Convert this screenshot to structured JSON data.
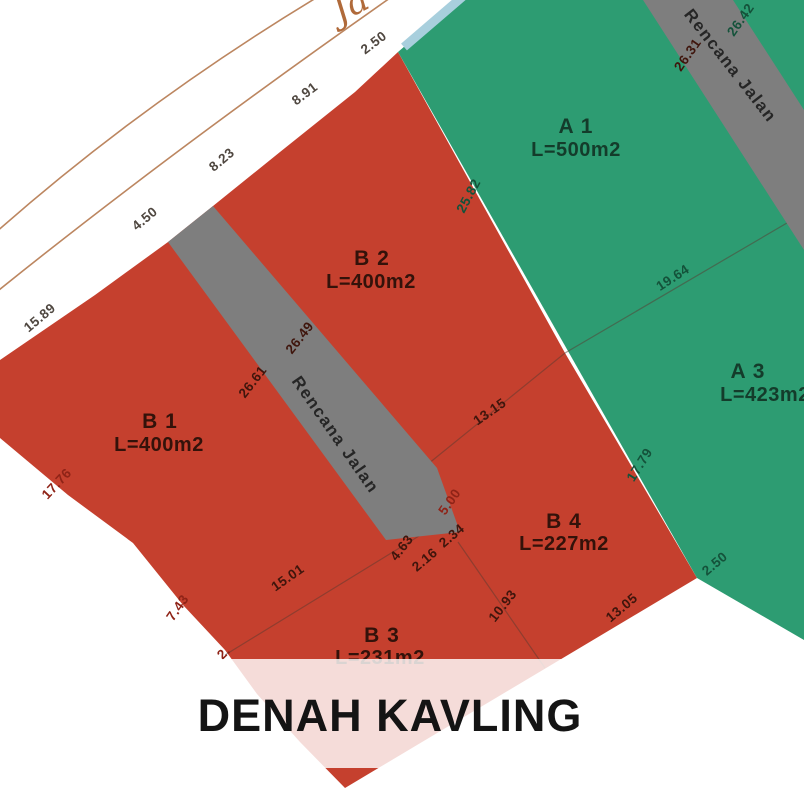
{
  "colors": {
    "plot_red": "#C5402E",
    "plot_green": "#2D9C72",
    "road_gray": "#7E7E7E",
    "overlay_band": "rgba(255,255,255,0.82)",
    "banner_text": "#141414",
    "road_line": "#bc8660",
    "water_line": "#a8cfdd"
  },
  "street": {
    "name_fragment": "Ja"
  },
  "banner": {
    "title": "DENAH KAVLING"
  },
  "strips": [
    {
      "label": "Rencana Jalan",
      "dim_right": "26.42",
      "dim_left": "26.31"
    },
    {
      "label": "Rencana Jalan",
      "dim_right": "26.49",
      "dim_left": "26.61"
    }
  ],
  "plots": [
    {
      "id": "A 1",
      "area": "L=500m2"
    },
    {
      "id": "A 3",
      "area": "L=423m2"
    },
    {
      "id": "B 1",
      "area": "L=400m2"
    },
    {
      "id": "B 2",
      "area": "L=400m2"
    },
    {
      "id": "B 3",
      "area": "L=231m2"
    },
    {
      "id": "B 4",
      "area": "L=227m2"
    }
  ],
  "dims": {
    "front_b1": "15.89",
    "front_road": "4.50",
    "front_b2_left": "8.23",
    "front_b2_right": "8.91",
    "front_green": "2.50",
    "b2_a1": "25.82",
    "a1_a3": "19.64",
    "b4_a3": "17.79",
    "a3_south": "2.50",
    "b2_b4": "13.15",
    "b1_b3": "15.01",
    "b3_b4": "10.93",
    "b4_south": "13.05",
    "b4_access": "5.00",
    "strip_end_a": "4.63",
    "strip_end_b": "2.16",
    "strip_end_c": "2.34",
    "b1_west": "17.76",
    "b1_sw": "7.43",
    "b3_partial": "2."
  }
}
